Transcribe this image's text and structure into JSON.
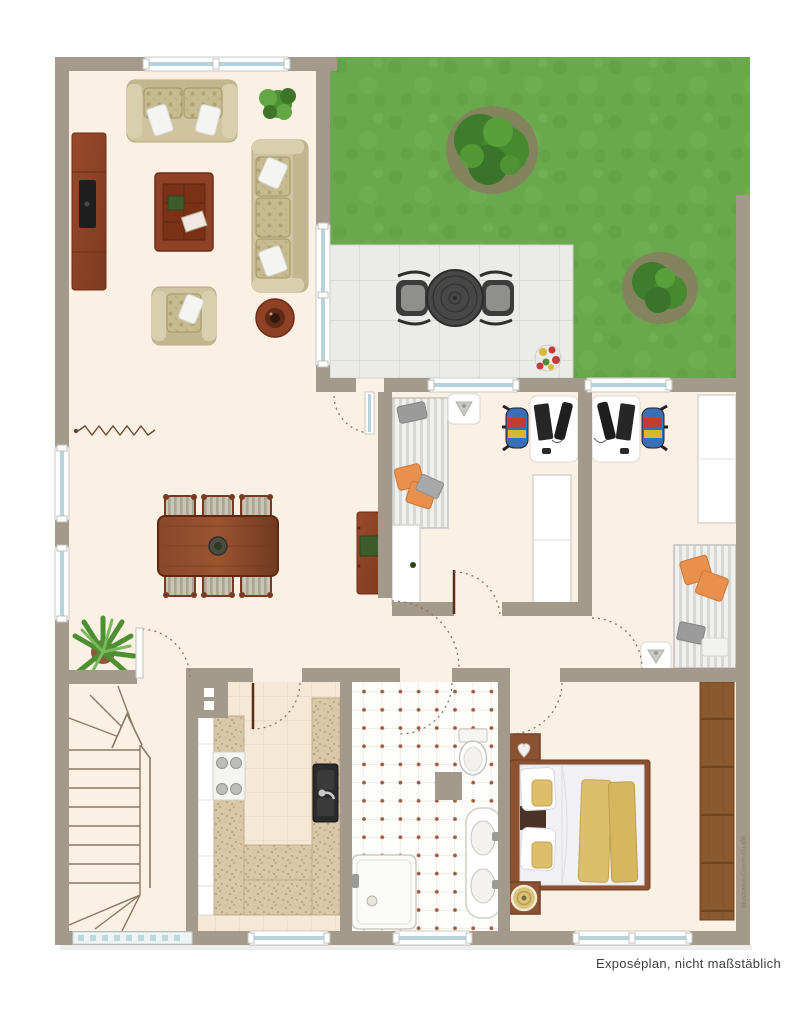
{
  "caption": "Exposéplan, nicht maßstäblich",
  "watermark": "Illustration©immoGrafik",
  "plan": {
    "type": "floor-plan",
    "scale_note": "nicht maßstäblich",
    "rooms": [
      {
        "name": "living-room",
        "furniture": [
          "two-seat-sofa",
          "three-seat-sofa",
          "armchair",
          "coffee-table",
          "tv-sideboard",
          "round-side-table",
          "potted-plant"
        ]
      },
      {
        "name": "dining-area",
        "furniture": [
          "dining-table",
          "dining-chairs-x6",
          "sideboard",
          "potted-plant",
          "wall-break-symbol"
        ]
      },
      {
        "name": "garden",
        "features": [
          "lawn",
          "bush-large",
          "bush-small",
          "terrace",
          "patio-table",
          "patio-chairs-x2",
          "flower-tub"
        ]
      },
      {
        "name": "study-1",
        "furniture": [
          "striped-daybed",
          "desk-with-pc",
          "office-chair",
          "wardrobe-left",
          "wardrobe-center",
          "corner-washbasin"
        ]
      },
      {
        "name": "study-2",
        "furniture": [
          "striped-daybed",
          "desk-with-pc",
          "office-chair",
          "wardrobe",
          "corner-washbasin"
        ]
      },
      {
        "name": "hallway",
        "furniture": []
      },
      {
        "name": "kitchen",
        "furniture": [
          "u-shaped-counter",
          "black-sink",
          "stove-4-burners",
          "tall-white-units",
          "chimney-flue"
        ]
      },
      {
        "name": "bathroom",
        "furniture": [
          "shower-tray",
          "toilet",
          "double-washbasin-counter",
          "partition-stub"
        ]
      },
      {
        "name": "bedroom",
        "furniture": [
          "double-bed",
          "nightstand-heart",
          "nightstand-lamp",
          "wardrobe-wood"
        ]
      },
      {
        "name": "staircase",
        "features": [
          "winder-stairs",
          "direction-arrow",
          "glass-block-window"
        ]
      }
    ],
    "colors": {
      "wall": "#a49a8c",
      "floor": "#faf0e3",
      "kitchen_floor": "#f5e8d7",
      "grass": "#6aa84d",
      "terrace": "#ebebe9",
      "wood_dark": "#8f4126",
      "sofa_beige": "#cfc49f",
      "accent_orange": "#e8914e",
      "bed_yellow": "#dcbf6c",
      "window_glass": "#b7d2da",
      "door_arc": "#8a7460"
    }
  }
}
